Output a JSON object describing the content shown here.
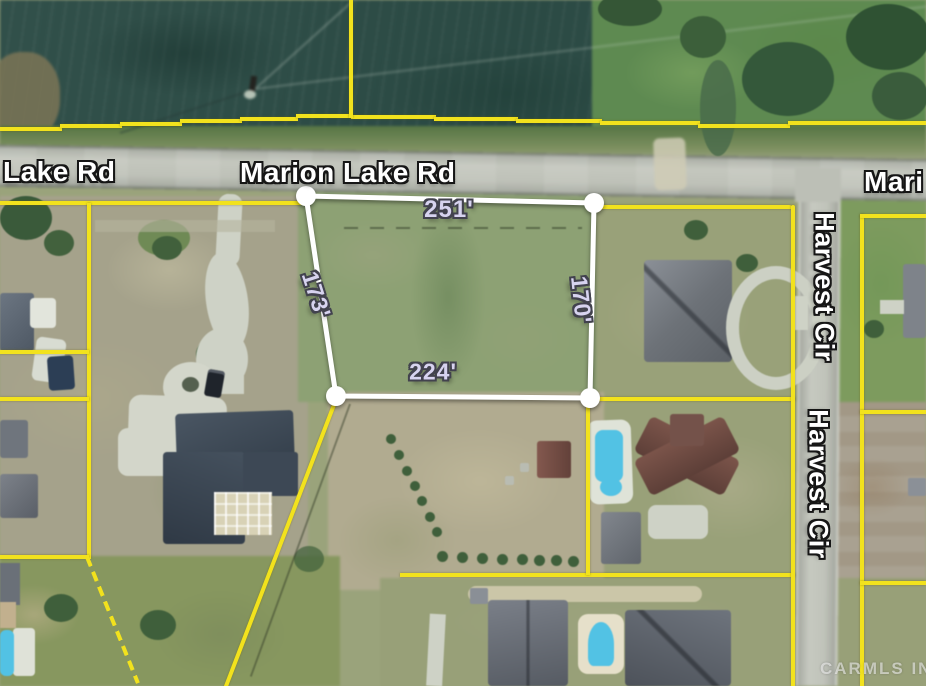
{
  "map": {
    "road_labels": {
      "lake_rd": "Lake Rd",
      "marion_lake_rd": "Marion Lake Rd",
      "marion_lake_rd_clipped": "Mari",
      "harvest_cir": "Harvest Cir"
    },
    "parcel_dimensions": {
      "north": "251'",
      "west": "173'",
      "east": "170'",
      "south": "224'"
    },
    "watermark": "CARMLS INC",
    "colors": {
      "boundary_yellow": "#f2e21d",
      "parcel_white": "#ffffff",
      "dimension_text": "#d7d3ef",
      "road_label_text": "#ffffff",
      "pool_blue": "#52c2e4"
    }
  }
}
